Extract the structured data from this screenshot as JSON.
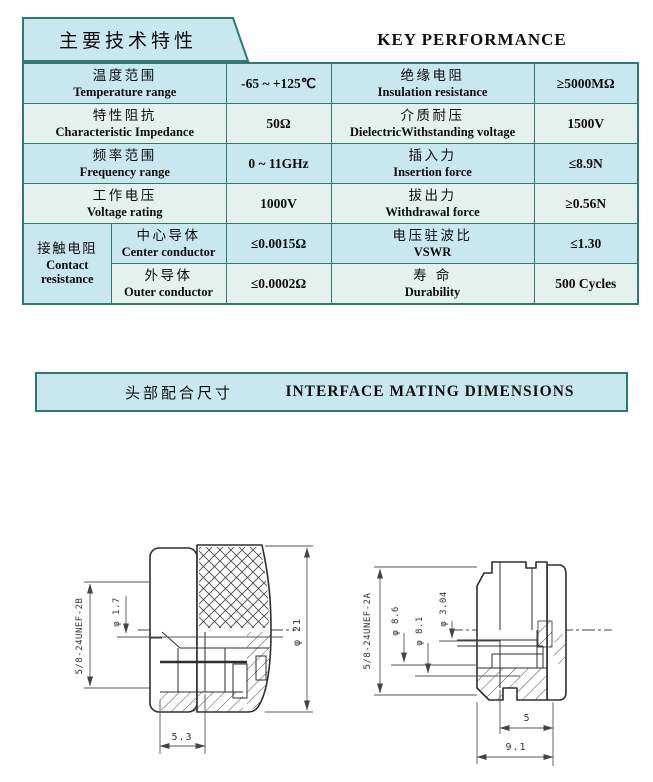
{
  "colors": {
    "header_fill": "#c9e7ef",
    "row_alt_fill": "#e4f1ed",
    "table_border": "#2f7a70"
  },
  "section1": {
    "tab_title": "主要技术特性",
    "title_en": "KEY PERFORMANCE"
  },
  "spec_table": {
    "group_label_cn": "接触电阻",
    "group_label_en": "Contact resistance",
    "rows": [
      {
        "param1_cn": "温度范围",
        "param1_en": "Temperature range",
        "value1": "-65 ~ +125℃",
        "param2_cn": "绝缘电阻",
        "param2_en": "Insulation resistance",
        "value2": "≥5000MΩ"
      },
      {
        "param1_cn": "特性阻抗",
        "param1_en": "Characteristic Impedance",
        "value1": "50Ω",
        "param2_cn": "介质耐压",
        "param2_en": "DielectricWithstanding voltage",
        "value2": "1500V"
      },
      {
        "param1_cn": "频率范围",
        "param1_en": "Frequency range",
        "value1": "0 ~ 11GHz",
        "param2_cn": "插入力",
        "param2_en": "Insertion force",
        "value2": "≤8.9N"
      },
      {
        "param1_cn": "工作电压",
        "param1_en": "Voltage rating",
        "value1": "1000V",
        "param2_cn": "拔出力",
        "param2_en": "Withdrawal force",
        "value2": "≥0.56N"
      },
      {
        "param1_cn": "中心导体",
        "param1_en": "Center conductor",
        "value1": "≤0.0015Ω",
        "param2_cn": "电压驻波比",
        "param2_en": "VSWR",
        "value2": "≤1.30"
      },
      {
        "param1_cn": "外导体",
        "param1_en": "Outer conductor",
        "value1": "≤0.0002Ω",
        "param2_cn": "寿  命",
        "param2_en": "Durability",
        "value2": "500 Cycles"
      }
    ]
  },
  "section2": {
    "tab_title": "头部配合尺寸",
    "title_en": "INTERFACE MATING DIMENSIONS"
  },
  "drawing_left": {
    "thread_label": "5/8-24UNEF-2B",
    "pin_dia": "φ 1.7",
    "outer_dia": "φ 21",
    "bore_width": "5.3"
  },
  "drawing_right": {
    "thread_label": "5/8-24UNEF-2A",
    "dia_a": "φ 8.6",
    "dia_b": "φ 8.1",
    "dia_c": "φ 3.04",
    "len_inner": "5",
    "len_overall": "9.1"
  }
}
